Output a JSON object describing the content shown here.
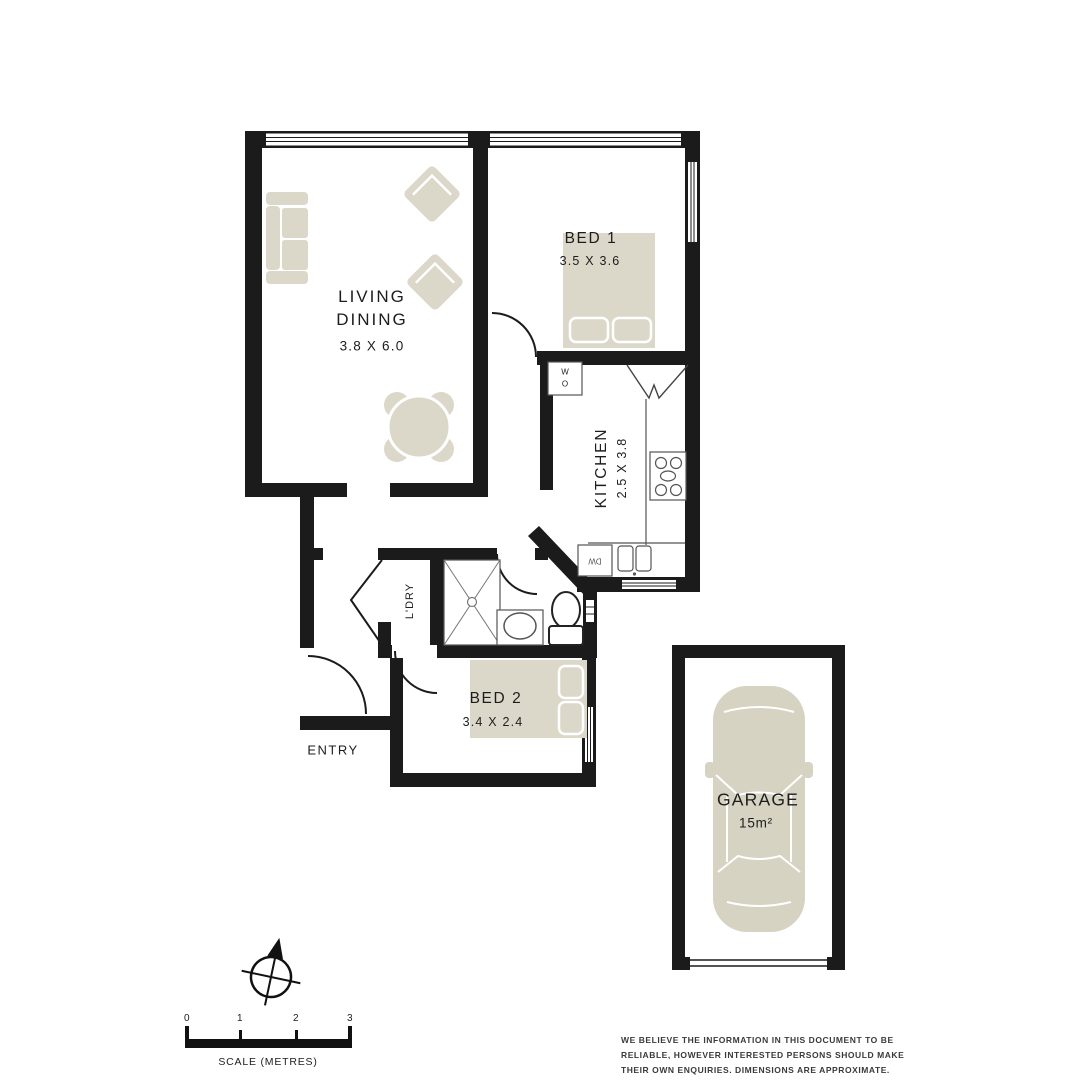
{
  "plan": {
    "rooms": {
      "living": {
        "label_line1": "LIVING",
        "label_line2": "DINING",
        "dims": "3.8 X 6.0"
      },
      "bed1": {
        "label": "BED 1",
        "dims": "3.5 X 3.6"
      },
      "kitchen": {
        "label": "KITCHEN",
        "dims": "2.5 X 3.8"
      },
      "laundry": {
        "label": "L'DRY"
      },
      "bed2": {
        "label": "BED 2",
        "dims": "3.4 X 2.4"
      },
      "entry": {
        "label": "ENTRY"
      },
      "garage": {
        "label": "GARAGE",
        "area": "15m²"
      }
    },
    "appliances": {
      "washer": "W",
      "oven": "O",
      "dishwasher": "DW"
    }
  },
  "scale_bar": {
    "labels": [
      "0",
      "1",
      "2",
      "3"
    ],
    "caption": "SCALE (METRES)"
  },
  "disclaimer": {
    "line1": "WE BELIEVE THE INFORMATION IN THIS DOCUMENT TO BE",
    "line2": "RELIABLE, HOWEVER INTERESTED PERSONS SHOULD MAKE",
    "line3": "THEIR OWN ENQUIRIES. DIMENSIONS ARE APPROXIMATE."
  },
  "colors": {
    "wall": "#1b1b1b",
    "furniture": "#dbd8c9",
    "fixture_stroke": "#555555",
    "text": "#1d1d1d"
  }
}
